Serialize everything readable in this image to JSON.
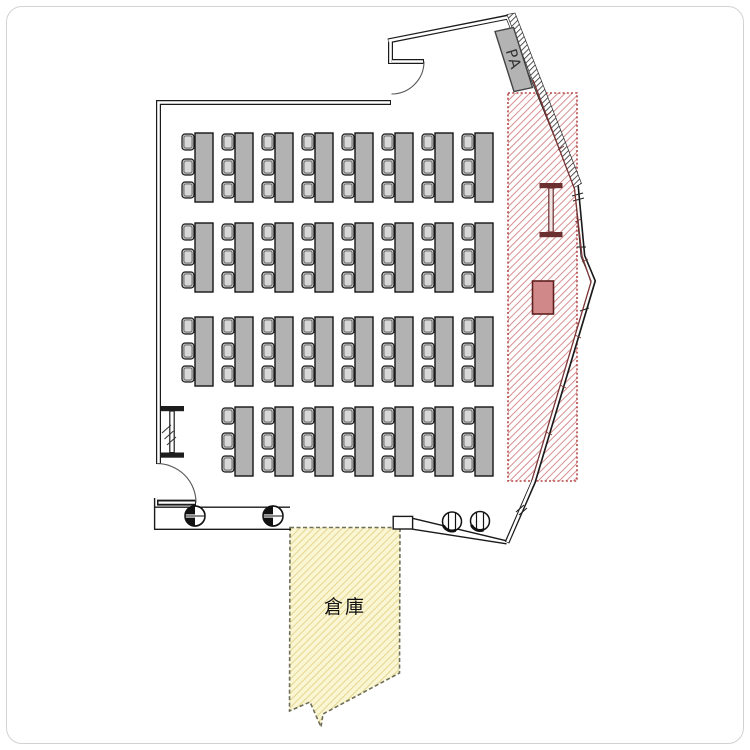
{
  "plan": {
    "title": "hall-floor-plan",
    "labels": {
      "pa_booth": "PA",
      "storage_room": "倉庫"
    },
    "zones": {
      "stage": {
        "name": "stage-hatched-zone",
        "border_color": "#b54848",
        "hatch_color": "#d68f8f",
        "x": 508,
        "y": 93,
        "w": 69,
        "h": 388
      },
      "storage": {
        "label": "倉庫",
        "fill": "#faf5d2",
        "hatch_color": "#e4d78f",
        "border_color": "#70705a"
      },
      "pa": {
        "label": "PA",
        "fill": "#b3b3b3"
      }
    },
    "furniture": {
      "x0": 182,
      "dx": 40,
      "desk": {
        "w": 18,
        "h": 69,
        "offset_x": 13,
        "fill": "#b2b2b2"
      },
      "chair": {
        "w": 12,
        "h": 16,
        "dys": [
          1,
          26,
          49
        ],
        "fill": "#bdbdbd",
        "inner_fill": "#d8d8d8"
      },
      "desk_rows": [
        {
          "y": 133,
          "cols": [
            0,
            1,
            2,
            3,
            4,
            5,
            6,
            7
          ]
        },
        {
          "y": 223,
          "cols": [
            0,
            1,
            2,
            3,
            4,
            5,
            6,
            7
          ]
        },
        {
          "y": 317,
          "cols": [
            0,
            1,
            2,
            3,
            4,
            5,
            6,
            7
          ]
        },
        {
          "y": 407,
          "cols": [
            1,
            2,
            3,
            4,
            5,
            6,
            7
          ]
        }
      ],
      "desk_count": 31,
      "chair_count": 93,
      "column_symbols": 4,
      "ibeam_symbols": 2
    },
    "colors": {
      "wall": "#1a1a1a",
      "stage_item": "#6b2f2f",
      "stage_solid_fill": "#d08888",
      "curtain": "#7c3434"
    }
  }
}
